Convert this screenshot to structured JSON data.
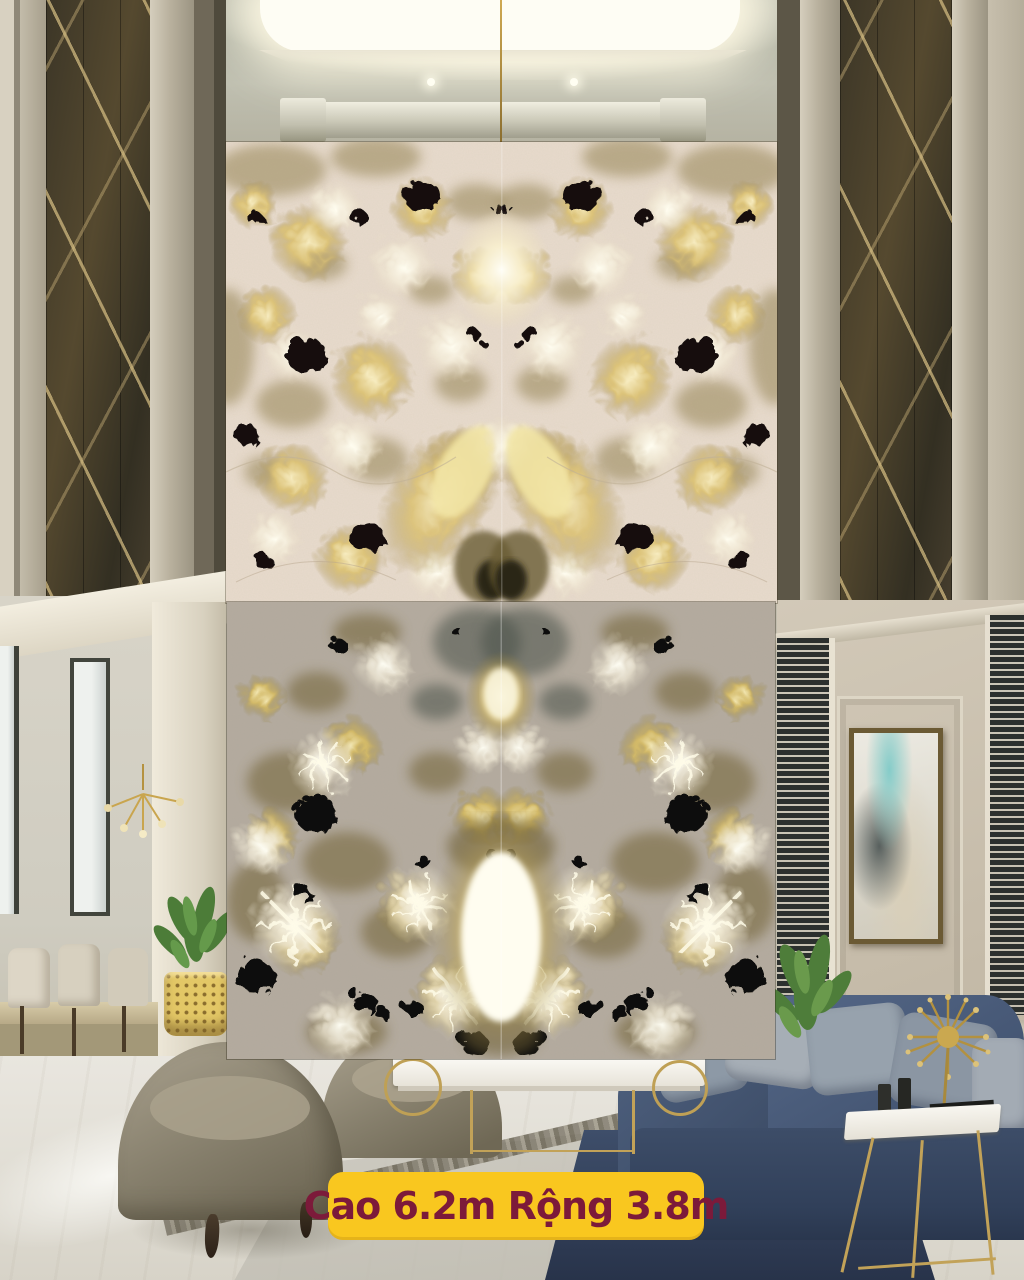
{
  "banner": {
    "label": "Cao 6.2m Rộng 3.8m",
    "background_color": "#F9C71F",
    "text_color": "#7C1A3A"
  },
  "slabs": {
    "top": {
      "name": "backlit-crystal-quartzite-slab-upper",
      "base_color": "#e8dbcd",
      "gold_color": "#c8ac5e",
      "spot_color": "#12100b"
    },
    "bottom": {
      "name": "backlit-crystal-quartzite-slab-lower",
      "base_color": "#b4ab9f",
      "gold_color": "#c2a754",
      "spot_color": "#0c0b08"
    }
  },
  "room": {
    "wall_color": "#cbc2b1",
    "mirror_tint_color": "#433b2b",
    "sofa_color": "#41536e",
    "rug_color": "#2f3c52",
    "gold_accent_color": "#c2a258",
    "floor_color": "#e7e4dd",
    "plant_color": "#567f3e",
    "artwork_teal_color": "#85ccc9"
  }
}
